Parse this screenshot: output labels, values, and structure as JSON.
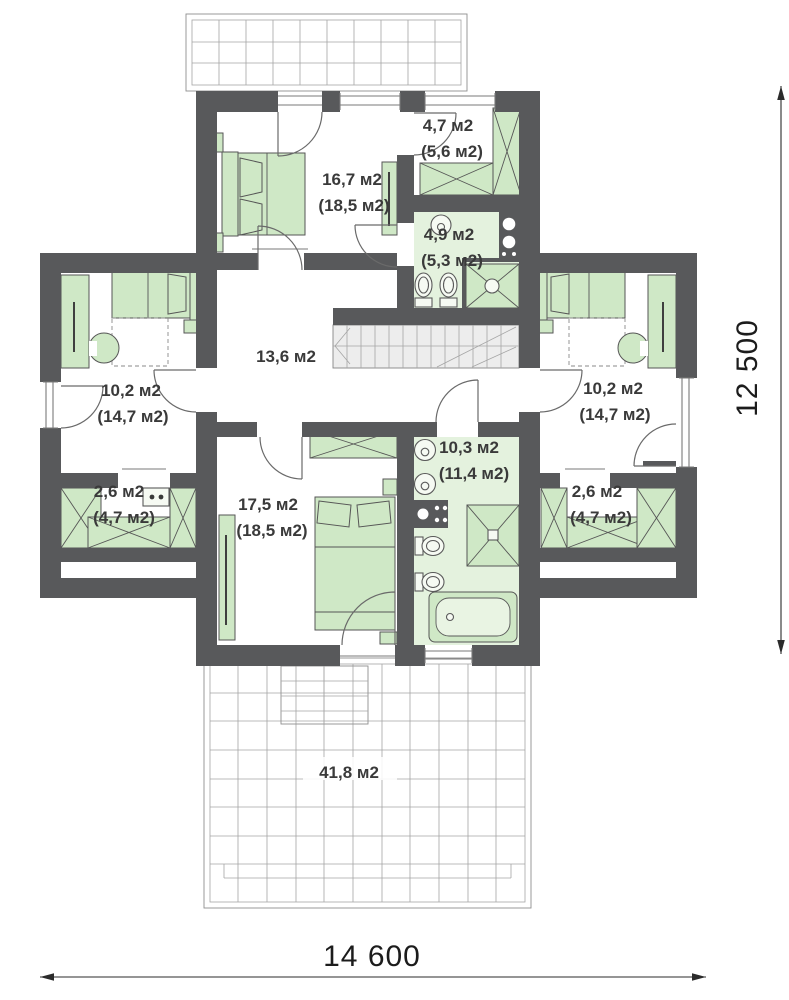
{
  "plan": {
    "rooms": [
      {
        "id": "bedroom-top",
        "area": "16,7 м2",
        "area_total": "(18,5 м2)"
      },
      {
        "id": "wardrobe-top",
        "area": "4,7 м2",
        "area_total": "(5,6 м2)"
      },
      {
        "id": "bathroom-top",
        "area": "4,9 м2",
        "area_total": "(5,3 м2)"
      },
      {
        "id": "bedroom-left",
        "area": "10,2 м2",
        "area_total": "(14,7 м2)"
      },
      {
        "id": "closet-left",
        "area": "2,6 м2",
        "area_total": "(4,7 м2)"
      },
      {
        "id": "hall",
        "area": "13,6 м2",
        "area_total": ""
      },
      {
        "id": "bedroom-bottom",
        "area": "17,5 м2",
        "area_total": "(18,5 м2)"
      },
      {
        "id": "bathroom-bottom",
        "area": "10,3 м2",
        "area_total": "(11,4 м2)"
      },
      {
        "id": "bedroom-right",
        "area": "10,2 м2",
        "area_total": "(14,7 м2)"
      },
      {
        "id": "closet-right",
        "area": "2,6 м2",
        "area_total": "(4,7 м2)"
      },
      {
        "id": "terrace-bottom",
        "area": "41,8 м2",
        "area_total": ""
      }
    ],
    "dimensions": {
      "width_label": "14 600",
      "height_label": "12 500"
    },
    "colors": {
      "wall": "#58595b",
      "furniture": "#cfe8c6",
      "furniture_stroke": "#565656",
      "bath_floor": "#e4f2de",
      "stair_fill": "#ededed",
      "text": "#3a3a3a",
      "dim_text": "#1c1c1c"
    },
    "icons": [
      "bed-icon",
      "wardrobe-icon",
      "desk-icon",
      "chair-icon",
      "sink-icon",
      "toilet-icon",
      "shower-icon",
      "bathtub-icon",
      "washer-icon",
      "staircase",
      "door-icon",
      "window-icon",
      "terrace-grid",
      "dimension-arrow-icon"
    ]
  }
}
